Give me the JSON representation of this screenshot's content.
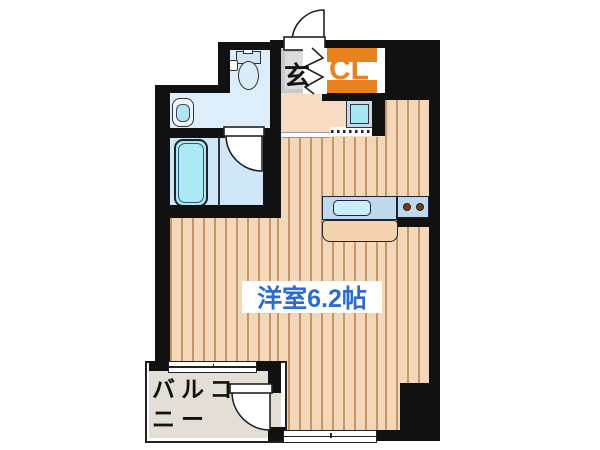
{
  "plan": {
    "labels": {
      "entrance": "玄",
      "closet": "CL",
      "main_room": "洋室6.2帖",
      "balcony_line1": "バルコ",
      "balcony_line2": "ニー"
    },
    "rooms": {
      "main_room_type": "洋室",
      "main_room_size_jo": "6.2帖"
    },
    "colors": {
      "wall": "#111111",
      "floor-base": "#f3d7b8",
      "floor-stripe": "#c3976c",
      "hall-floor": "#f6dcc3",
      "genkan-floor": "#c9c9c9",
      "genkan-inner": "#dcdcdc",
      "wet-floor": "#ddeefa",
      "bath-floor": "#cfe7f7",
      "tub-fill": "#ade9f3",
      "balcony-floor": "#e3ded6",
      "closet-accent": "#e9811f",
      "room-label-blue": "#2a6cd2",
      "counter-fill": "#bed9ed",
      "sink-fill": "#cbeffa",
      "wm-fill": "#a5e8f4",
      "table-fill": "#f3d4ae",
      "burner-brown": "#7a3a12"
    }
  }
}
